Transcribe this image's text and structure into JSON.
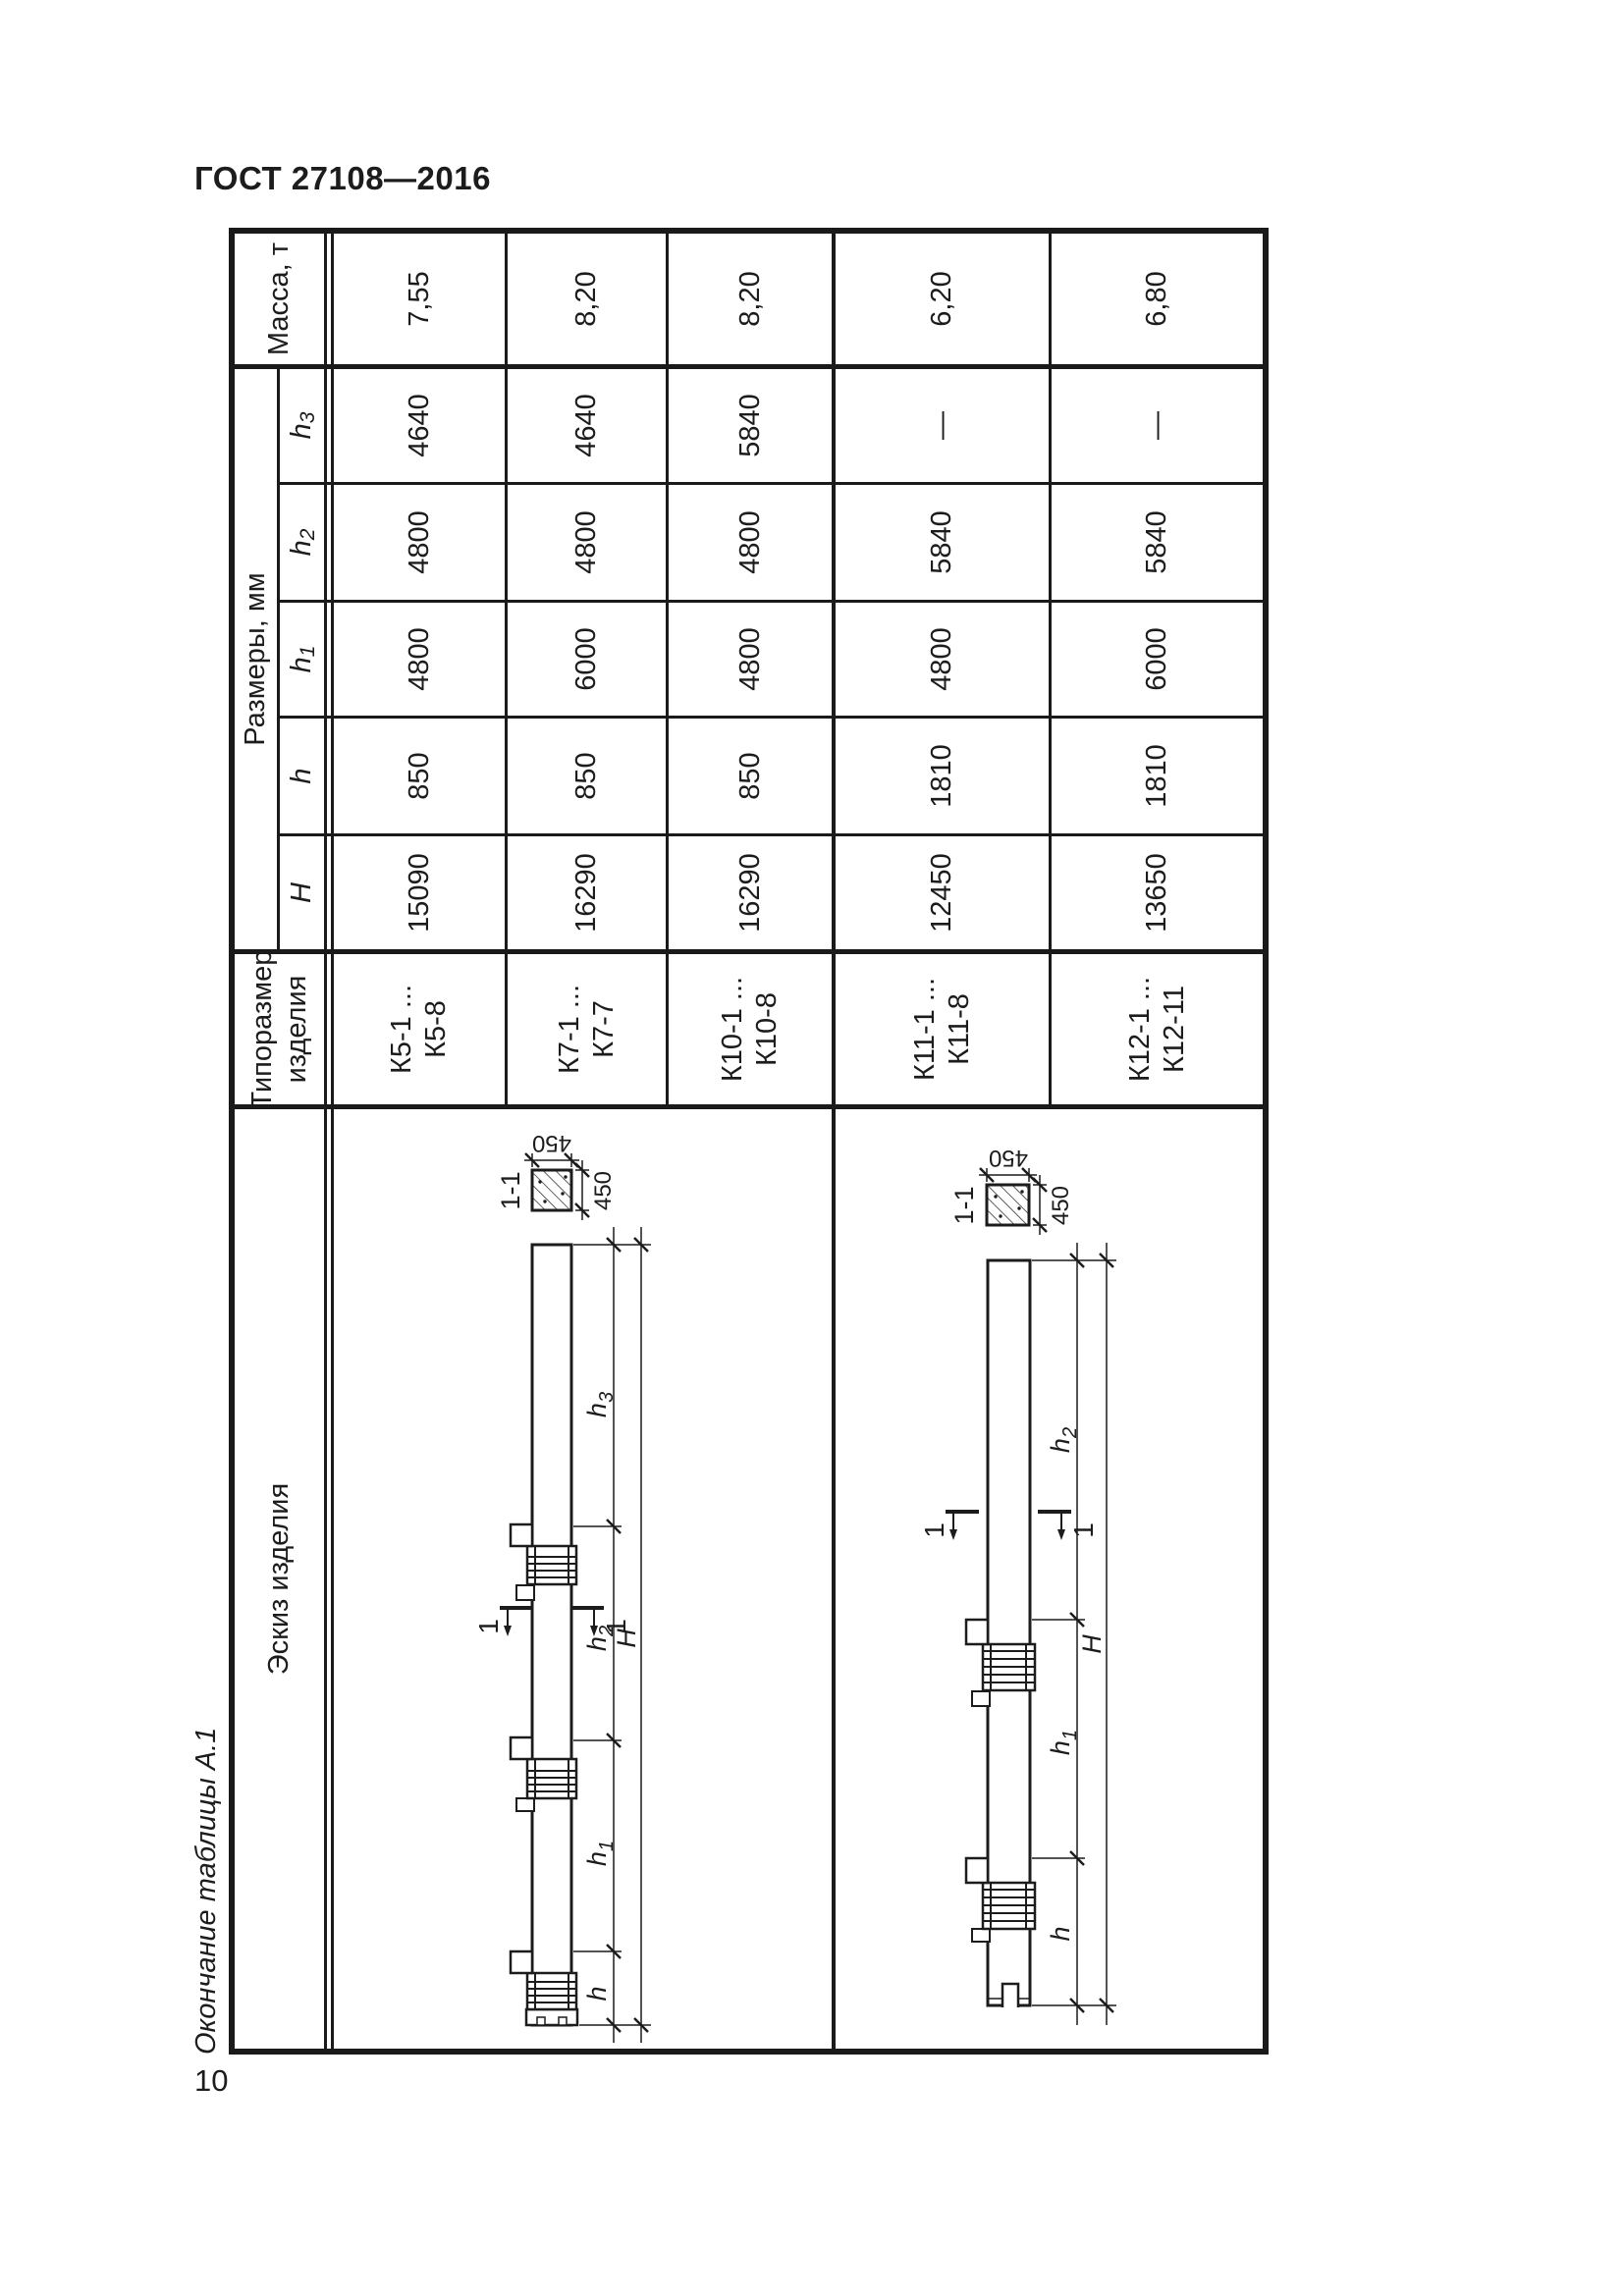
{
  "page": {
    "standard_number": "ГОСТ 27108—2016",
    "table_caption": "Окончание таблицы А.1",
    "page_number": "10"
  },
  "colors": {
    "ink": "#1c1c1c",
    "paper": "#ffffff"
  },
  "table": {
    "headers": {
      "sketch": "Эскиз изделия",
      "type_size_line1": "Типоразмер",
      "type_size_line2": "изделия",
      "dimensions_group": "Размеры, мм",
      "dim_H": "H",
      "dim_h": "h",
      "dim_h1_base": "h",
      "dim_h1_sub": "1",
      "dim_h2_base": "h",
      "dim_h2_sub": "2",
      "dim_h3_base": "h",
      "dim_h3_sub": "3",
      "mass": "Масса, т"
    },
    "rows": [
      {
        "type_line1": "К5-1 ...",
        "type_line2": "К5-8",
        "H": "15090",
        "h": "850",
        "h1": "4800",
        "h2": "4800",
        "h3": "4640",
        "mass": "7,55"
      },
      {
        "type_line1": "К7-1 ...",
        "type_line2": "К7-7",
        "H": "16290",
        "h": "850",
        "h1": "6000",
        "h2": "4800",
        "h3": "4640",
        "mass": "8,20"
      },
      {
        "type_line1": "К10-1 ...",
        "type_line2": "К10-8",
        "H": "16290",
        "h": "850",
        "h1": "4800",
        "h2": "4800",
        "h3": "5840",
        "mass": "8,20"
      },
      {
        "type_line1": "К11-1 ...",
        "type_line2": "К11-8",
        "H": "12450",
        "h": "1810",
        "h1": "4800",
        "h2": "5840",
        "h3": "—",
        "mass": "6,20"
      },
      {
        "type_line1": "К12-1 ...",
        "type_line2": "К12-11",
        "H": "13650",
        "h": "1810",
        "h1": "6000",
        "h2": "5840",
        "h3": "—",
        "mass": "6,80"
      }
    ]
  },
  "sketches": {
    "section_label": "1-1",
    "cut_mark_label": "1",
    "section_width": "450",
    "section_height": "450",
    "dim_H": "H",
    "dim_h": "h",
    "dim_h1_base": "h",
    "dim_h1_sub": "1",
    "dim_h2_base": "h",
    "dim_h2_sub": "2",
    "dim_h3_base": "h",
    "dim_h3_sub": "3"
  }
}
